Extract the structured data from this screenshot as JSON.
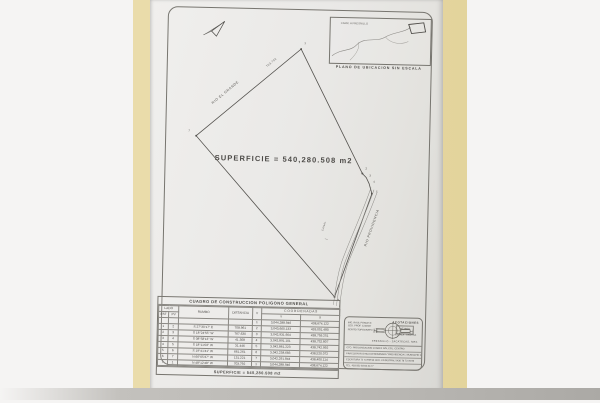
{
  "plan": {
    "surface_text": "SUPERFICIE = 540,280.508 m2",
    "edge_label_nw": "RIO EL GRANDE",
    "edge_label_se": "RIO PROVIDENCIA",
    "canal_label": "CANAL",
    "apex_distance_label": "703.792",
    "vertices": [
      "1",
      "2",
      "3",
      "4",
      "5",
      "6",
      "7"
    ],
    "inset": {
      "caption": "PLANO DE UBICACION SIN ESCALA",
      "road_label": "CARR. A FRESNILLO"
    }
  },
  "table": {
    "title": "CUADRO DE CONSTRUCCION POLIGONO GENERAL",
    "headers": {
      "lado": "LADO",
      "est": "EST",
      "pv": "PV",
      "rumbo": "RUMBO",
      "distancia": "DISTANCIA",
      "v": "V",
      "coordenadas": "C O O R D E N A D A S",
      "y": "Y",
      "x": "X"
    },
    "rows": [
      {
        "est": "",
        "pv": "",
        "rumbo": "",
        "dist": "",
        "v": "1",
        "y": "3,044,288.946",
        "x": "438,674.122"
      },
      {
        "est": "1",
        "pv": "2",
        "rumbo": "S 27°30'17\" E",
        "dist": "708.961",
        "v": "2",
        "y": "3,043,660.133",
        "x": "439,001.480"
      },
      {
        "est": "2",
        "pv": "3",
        "rumbo": "S 18°24'55\" W",
        "dist": "767.630",
        "v": "3",
        "y": "3,042,931.904",
        "x": "438,759.251"
      },
      {
        "est": "3",
        "pv": "4",
        "rumbo": "S 08°58'13\" W",
        "dist": "41.308",
        "v": "4",
        "y": "3,042,891.101",
        "x": "438,752.807"
      },
      {
        "est": "4",
        "pv": "5",
        "rumbo": "S 18°11'03\" W",
        "dist": "31.446",
        "v": "5",
        "y": "3,042,861.223",
        "x": "438,742.992"
      },
      {
        "est": "5",
        "pv": "6",
        "rumbo": "S 19°41'41\" W",
        "dist": "661.261",
        "v": "6",
        "y": "3,042,238.683",
        "x": "438,520.072"
      },
      {
        "est": "6",
        "pv": "7",
        "rumbo": "N 66°05'37\" W",
        "dist": "131.221",
        "v": "7",
        "y": "3,042,291.844",
        "x": "438,400.114"
      },
      {
        "est": "7",
        "pv": "1",
        "rumbo": "N 48°12'48\" W",
        "dist": "703.792",
        "v": "1",
        "y": "3,044,288.946",
        "x": "438,674.122"
      }
    ],
    "footer": "SUPERFICIE = 540,280.508 m2"
  },
  "titleblock": {
    "acotaciones_label": "ACOTACIONES",
    "acotaciones_value": "METROS",
    "escala_line": "ESCALA : GRAFICA",
    "logo_left": "H",
    "logo_right": "H",
    "owner_lines": [
      "ING. RAUL PONCE R.",
      "CED. PROF. 1234567",
      "PERITO TOPOGRAFO"
    ],
    "location_line": "FRESNILLO - ZACATECAS, MEX.",
    "detail_lines": [
      "CTO. PROLONGACION JUAREZ S/N, COL. CENTRO",
      "FRACCION RUSTICA DENOMINADA \"PROVIDENCIA\", MUNICIPIO DE FRESNILLO, ZACATECAS",
      "ESCRITURA 72 73 RM 93        CED. CATASTRAL 5436 78 73 78 96",
      "TEL. 493 932 93 93 33 77"
    ]
  },
  "colors": {
    "folder": "#e7d8a2",
    "paper": "#eae9e7",
    "line": "#55534f"
  }
}
